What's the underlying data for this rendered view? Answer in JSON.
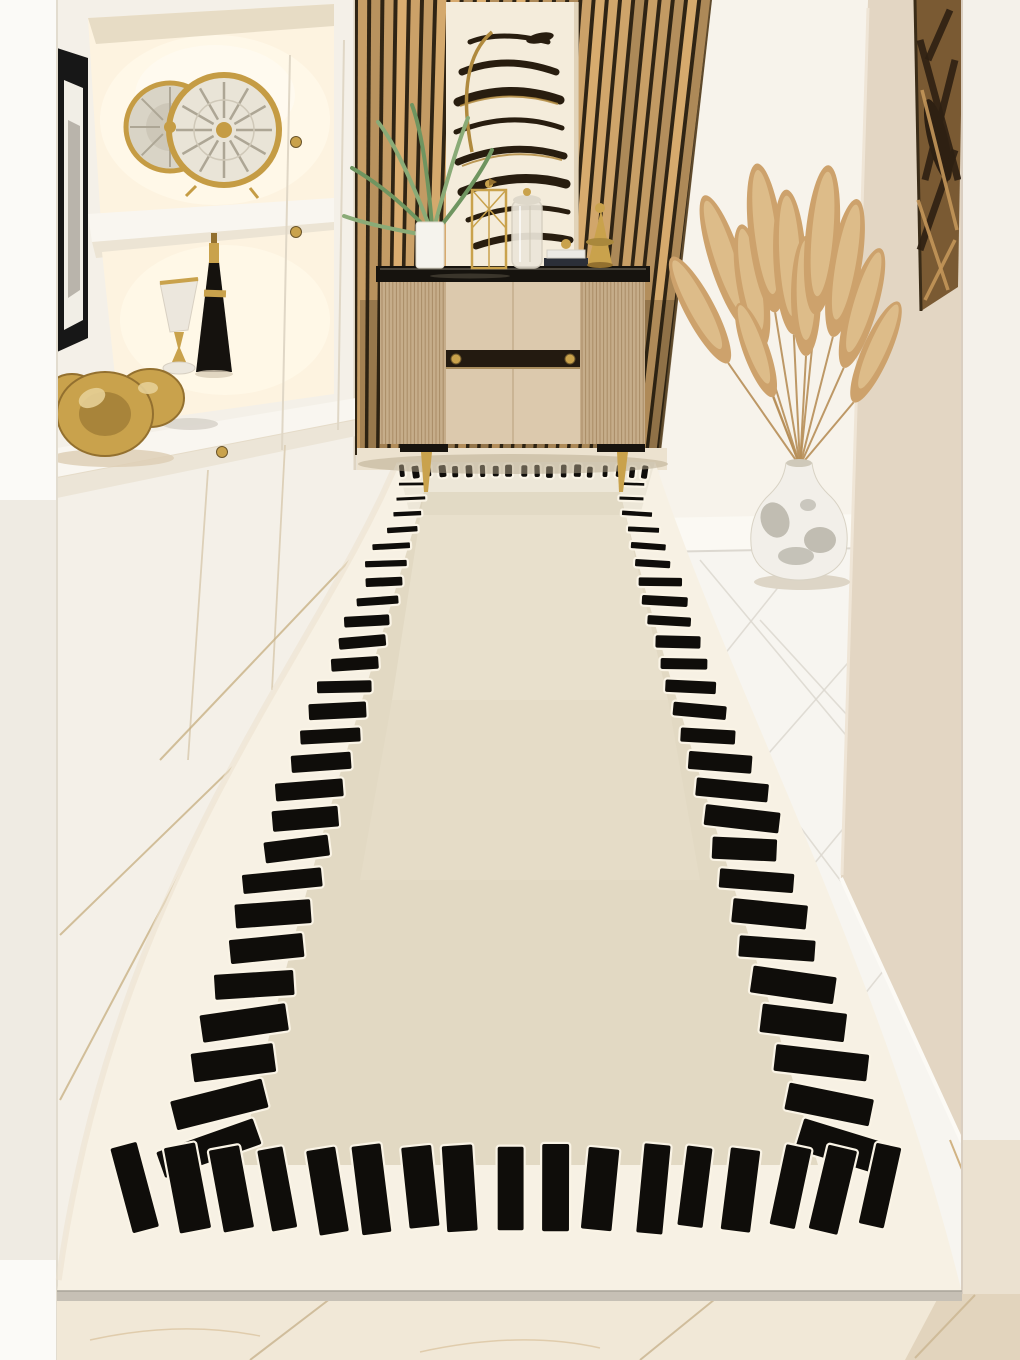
{
  "image": {
    "type": "interior-product-photo",
    "subject": "Cream hallway runner rug with hand-drawn black dash border, styled in a beige luxury entryway",
    "width": 1020,
    "height": 1360
  },
  "palette": {
    "wall_white": "#f4f0e8",
    "left_white": "#fbfaf7",
    "left_strip_shadow": "#e9e4da",
    "niche_bg": "#fdf3e0",
    "niche_glow": "#fff8e8",
    "shelf_face": "#f9f6f0",
    "shelf_shadow": "#ece4d4",
    "frame_black": "#171717",
    "frame_mat": "#f1eee6",
    "clock_gold": "#c59c44",
    "clock_face": "#e9e4d7",
    "clock_face_back": "#d9d4c6",
    "spoke": "#ada695",
    "marble": "#ece7dd",
    "black": "#15120e",
    "gold": "#c9a24c",
    "gold_dark": "#93702f",
    "gold_light": "#e6cf96",
    "wood_dark": "#2f2414",
    "wood_slat": "#c79e66",
    "art_canvas": "#f4ecdb",
    "art_stroke": "#281d0f",
    "art_gold": "#b08a3e",
    "console_body": "#d6c3a6",
    "console_rib": "#c6ad8a",
    "console_rib_line": "#a98c66",
    "console_door": "#dcc9ad",
    "console_seam": "#c3ad8c",
    "glass": "#16130e",
    "glass_hi": "#6e675a",
    "leaf": "#6f9560",
    "leaf_light": "#8aab77",
    "white_wall": "#f7f3eb",
    "baseboard": "#fbf9f3",
    "tile_white": "#f7f5f0",
    "tile_seam": "#dcd8d0",
    "right_wall": "#e3d6c3",
    "right_wall_hi": "#efe5d6",
    "right_art_bg": "#7a5a33",
    "right_art_dark": "#2e2012",
    "right_art_gold": "#c49659",
    "right_strip": "#f4f1ea",
    "right_strip_warm": "#eadfcd",
    "pampas": "#cda26c",
    "pampas_light": "#e2c493",
    "stem": "#b78f58",
    "vase_white": "#f2efe9",
    "vase_gray": "#8f8b7c",
    "vase_shadow": "#d9d1c0",
    "rug_band": "#f7f1e4",
    "rug_band_shadow": "#ece3d1",
    "rug_field": "#e2d9c3",
    "rug_field_light": "#eae2cf",
    "rug_black": "#0f0d0a",
    "rug_halo": "#faf4e6",
    "rug_edge": "#c6c0b5",
    "floor_wedge": "#ece2cf",
    "floor_cream": "#f1e8d7",
    "floor_beige": "#e2d4bd",
    "floor_seam": "#cdb996",
    "shadow_warm": "#b5a78c"
  },
  "scene": {
    "objects": [
      "left-display-shelving",
      "gold-round-mirror-clocks",
      "framed-art-slice",
      "marble-gold-goblet",
      "black-gold-bottle",
      "gold-abstract-sculpture",
      "white-cabinet-doors",
      "wood-slat-accent-wall",
      "abstract-zebra-artwork",
      "beige-console-cabinet",
      "palm-plant-white-pot",
      "gold-wire-lantern",
      "glass-canister",
      "stacked-books",
      "gold-cone-ornament",
      "pampas-grass-arrangement",
      "ceramic-floor-vase",
      "right-abstract-wall-art",
      "white-tile-floor",
      "cream-runner-rug"
    ]
  },
  "rug": {
    "description": "Cream runner rug, light ivory outer band, greige inner field, irregular hand-painted black dashes forming the border (small at far end, large tilted bars at near end)",
    "dash_counts": {
      "top": 19,
      "left": 26,
      "right": 26,
      "bottom": 17
    }
  },
  "pampas": {
    "plume_count": 11
  }
}
